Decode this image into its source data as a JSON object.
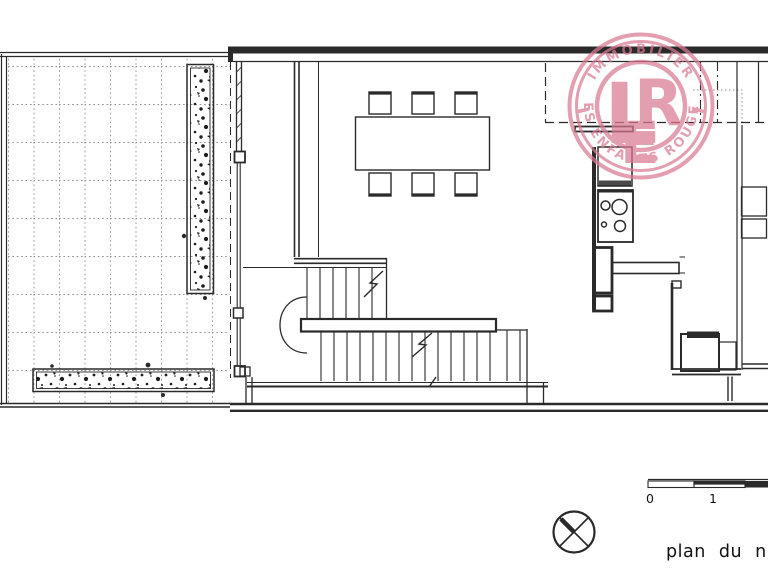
{
  "watermark": {
    "arc_top": "IMMOBILIER",
    "arc_bottom": "LES ENFANTS ROUGES",
    "monogram": {
      "l": "L",
      "e": "E",
      "r": "R"
    },
    "color": "#d97a92"
  },
  "scale_bar": {
    "label_zero": "0",
    "label_one": "1"
  },
  "caption": "plan du niveau",
  "icons": {
    "north": "circled-x-survey-mark",
    "stove": "four-burner-cooktop",
    "vegetation": "planter-speckle-texture"
  },
  "colors": {
    "ink": "#2a2a2a",
    "grid": "#8f8f8f",
    "pink": "#d97a92",
    "background": "#ffffff"
  }
}
